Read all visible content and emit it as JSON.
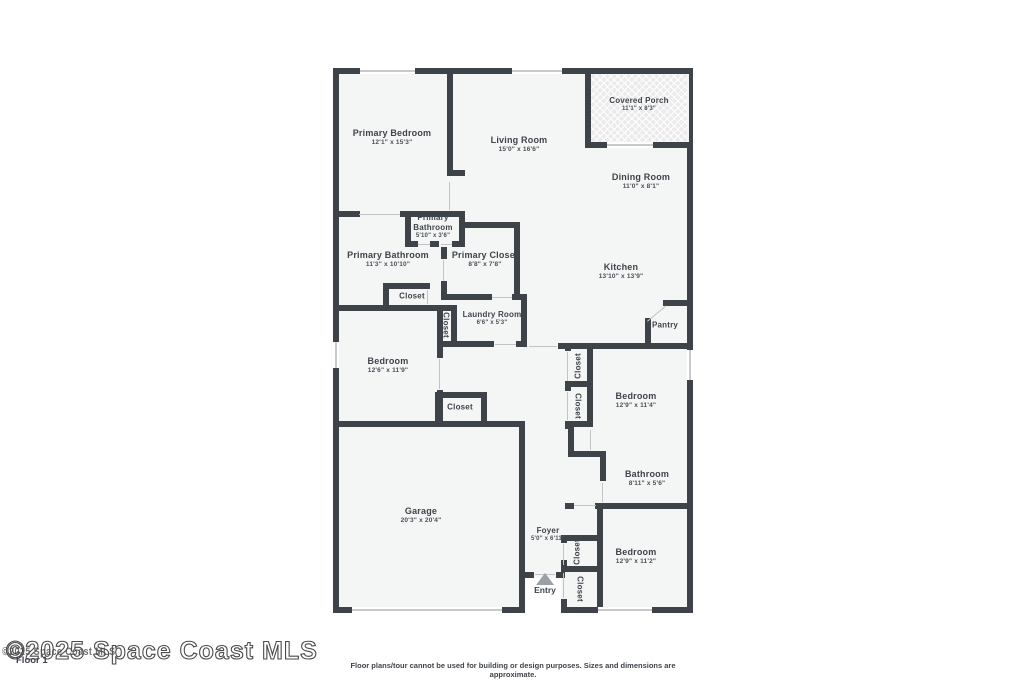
{
  "watermark": {
    "text": "©2025 Space Coast MLS",
    "overlay_text": "©2025 Space Coast MLS"
  },
  "floor_label": "Floor 1",
  "footer": {
    "disclaimer": "Floor plans/tour cannot be used for building or design purposes. Sizes and dimensions are approximate."
  },
  "entry": {
    "label": "Entry"
  },
  "colors": {
    "wall": "#3e434a",
    "floor": "#f4f5f5",
    "window": "#c9c9cb",
    "text": "#3f444b",
    "entry_arrow": "#9aa0a6",
    "porch_fill": "#ebebec"
  },
  "rooms": [
    {
      "name": "Primary Bedroom",
      "dims": "12'1\" x 15'3\"",
      "x": 392,
      "y": 138,
      "cls": ""
    },
    {
      "name": "Living Room",
      "dims": "15'0\" x 16'6\"",
      "x": 519,
      "y": 145,
      "cls": ""
    },
    {
      "name": "Covered Porch",
      "dims": "11'1\" x 8'3\"",
      "x": 639,
      "y": 105,
      "cls": "small"
    },
    {
      "name": "Dining Room",
      "dims": "11'0\" x 8'1\"",
      "x": 641,
      "y": 182,
      "cls": ""
    },
    {
      "name": "Primary Bathroom",
      "dims": "5'10\" x 3'6\"",
      "x": 433,
      "y": 227,
      "cls": "small narrow"
    },
    {
      "name": "Primary Bathroom",
      "dims": "11'3\" x 10'10\"",
      "x": 388,
      "y": 260,
      "cls": ""
    },
    {
      "name": "Primary Closet",
      "dims": "8'8\" x 7'8\"",
      "x": 485,
      "y": 260,
      "cls": ""
    },
    {
      "name": "Laundry Room",
      "dims": "6'6\" x 5'3\"",
      "x": 492,
      "y": 319,
      "cls": "small"
    },
    {
      "name": "Kitchen",
      "dims": "13'10\" x 13'9\"",
      "x": 621,
      "y": 272,
      "cls": ""
    },
    {
      "name": "Bedroom",
      "dims": "12'6\" x 11'9\"",
      "x": 388,
      "y": 366,
      "cls": ""
    },
    {
      "name": "Bedroom",
      "dims": "12'9\" x 11'4\"",
      "x": 636,
      "y": 401,
      "cls": ""
    },
    {
      "name": "Bathroom",
      "dims": "8'11\" x 5'6\"",
      "x": 647,
      "y": 479,
      "cls": ""
    },
    {
      "name": "Bedroom",
      "dims": "12'9\" x 11'2\"",
      "x": 636,
      "y": 557,
      "cls": ""
    },
    {
      "name": "Garage",
      "dims": "20'3\" x 20'4\"",
      "x": 421,
      "y": 516,
      "cls": ""
    },
    {
      "name": "Foyer",
      "dims": "5'0\" x 6'11\"",
      "x": 548,
      "y": 535,
      "cls": "small"
    }
  ],
  "closets": [
    {
      "label": "Closet",
      "x": 412,
      "y": 296,
      "orient": "h"
    },
    {
      "label": "Closet",
      "x": 446,
      "y": 325,
      "orient": "vdown"
    },
    {
      "label": "Closet",
      "x": 460,
      "y": 407,
      "orient": "h"
    },
    {
      "label": "Closet",
      "x": 578,
      "y": 366,
      "orient": "vup"
    },
    {
      "label": "Closet",
      "x": 578,
      "y": 406,
      "orient": "vdown"
    },
    {
      "label": "Closet",
      "x": 577,
      "y": 552,
      "orient": "vup"
    },
    {
      "label": "Closet",
      "x": 580,
      "y": 589,
      "orient": "vdown"
    },
    {
      "label": "Pantry",
      "x": 665,
      "y": 325,
      "orient": "h"
    }
  ]
}
